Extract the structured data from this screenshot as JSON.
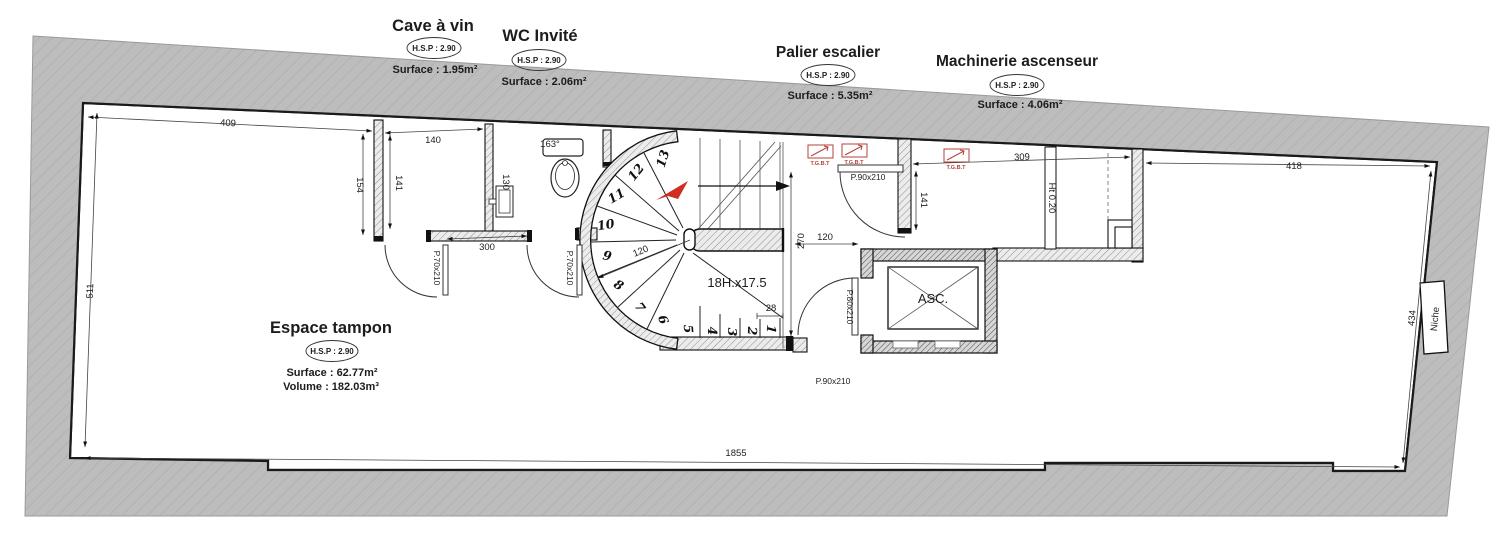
{
  "page": {
    "background": "#ffffff"
  },
  "colors": {
    "site_band": "#bdbdbd",
    "wall_outline": "#1a1a1a",
    "tgbt_red": "#b5413a",
    "arrow_red": "#cf2e21"
  },
  "rooms": {
    "cave": {
      "title": "Cave à vin",
      "hsp": "H.S.P : 2.90",
      "surface": "Surface : 1.95m²"
    },
    "wc": {
      "title": "WC Invité",
      "hsp": "H.S.P : 2.90",
      "surface": "Surface : 2.06m²"
    },
    "palier": {
      "title": "Palier escalier",
      "hsp": "H.S.P : 2.90",
      "surface": "Surface : 5.35m²"
    },
    "machinerie": {
      "title": "Machinerie ascenseur",
      "hsp": "H.S.P : 2.90",
      "surface": "Surface : 4.06m²"
    },
    "tampon": {
      "title": "Espace tampon",
      "hsp": "H.S.P : 2.90",
      "surface": "Surface : 62.77m²",
      "volume": "Volume : 182.03m³"
    }
  },
  "dims": {
    "top_left": "409",
    "left_wall": "511",
    "seg_154": "154",
    "cave_width": "140",
    "cave_height": "141",
    "wc_angle": "163°",
    "sink_width": "130",
    "front_300": "300",
    "stair_radius": "120",
    "stair_steps_note": "18H.x17.5",
    "stair_tread": "28",
    "stair_height": "270",
    "palier_width": "120",
    "palier_height": "141",
    "mach_width": "309",
    "mach_curb": "Ht 0.20",
    "top_right": "418",
    "right_wall": "434",
    "overall_width": "1855"
  },
  "doors": {
    "cave_door": "P.70x210",
    "wc_door": "P.70x210",
    "palier_door": "P.90x210",
    "tampon_door": "P.90x210",
    "elevator_door": "P.80x210"
  },
  "fixtures": {
    "elevator": "ASC.",
    "niche": "Niche",
    "tgbt": "T.G.B.T"
  },
  "stair": {
    "steps": [
      "1",
      "2",
      "3",
      "4",
      "5",
      "6",
      "7",
      "8",
      "9",
      "10",
      "11",
      "12",
      "13"
    ]
  }
}
